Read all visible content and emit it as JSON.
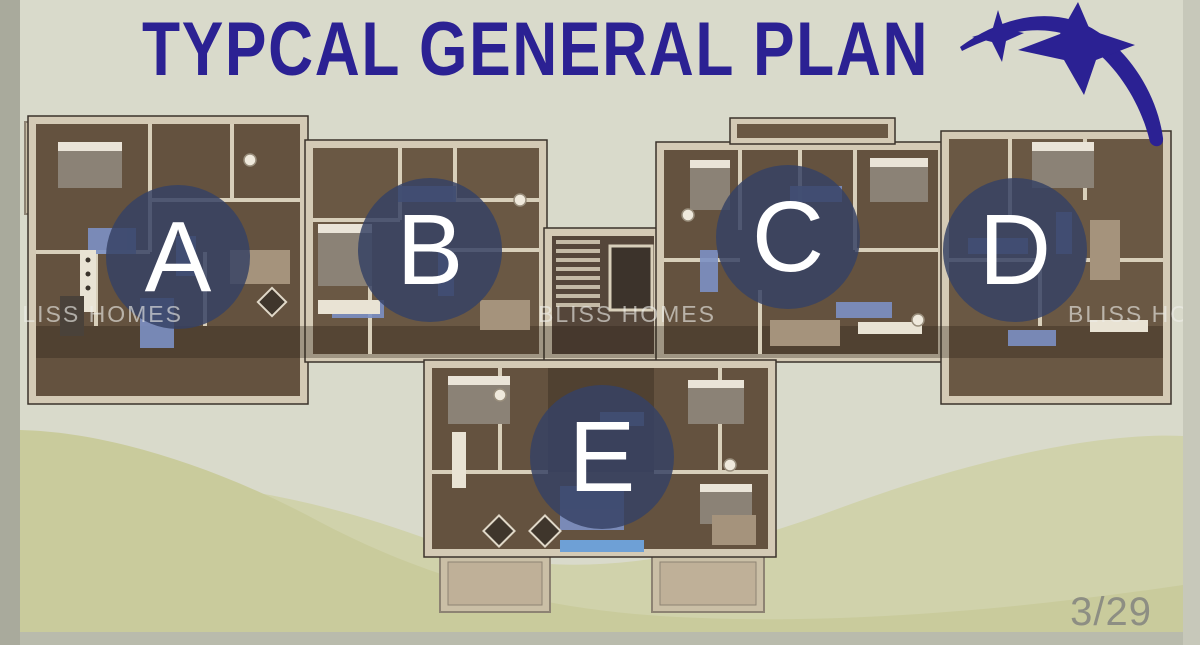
{
  "page": {
    "title": "TYPCAL GENERAL PLAN",
    "page_indicator": "3/29"
  },
  "watermarks": [
    "BLISS HOMES",
    "BLISS HOMES",
    "BLISS HOMES"
  ],
  "units": [
    {
      "label": "A"
    },
    {
      "label": "B"
    },
    {
      "label": "C"
    },
    {
      "label": "D"
    },
    {
      "label": "E"
    }
  ],
  "plan": {
    "kind": "typical-floor-plan",
    "units_count": 5
  },
  "colors": {
    "accent_indigo": "#2b2193",
    "badge_fill": "rgba(54,66,100,0.84)",
    "badge_letter": "#ffffff",
    "background": "#d9dacb",
    "wave_dark": "#c9cb9c",
    "wave_light": "#d0d2ab",
    "frame_left": "#a9aa9c",
    "frame_right": "#c7c8ba",
    "frame_bottom": "#b9bbac",
    "floor_wood": "#64523f",
    "wall_cream": "#d4cab5",
    "watermark_text_color": "rgba(238,238,232,0.62)",
    "page_number_color": "#8d8e83"
  }
}
